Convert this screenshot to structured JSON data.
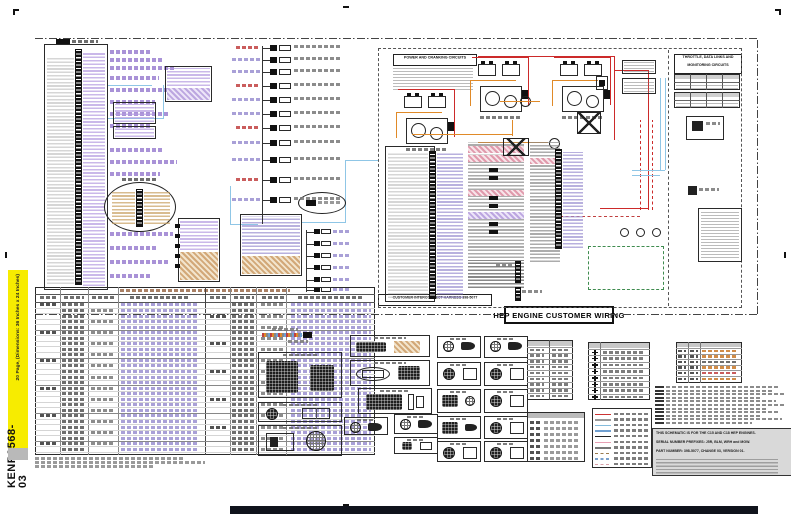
{
  "page": {
    "sheet_code": "KENR9568-03",
    "sheet_subtitle": "20 Page, (Dimensions: 36 Inches x 24 Inches)"
  },
  "titles": {
    "main": "HEP ENGINE CUSTOMER WIRING",
    "power_cranking": "POWER AND CRANKING CIRCUITS",
    "throttle_line1": "THROTTLE, DATA LINKS AND",
    "throttle_line2": "MONITORING CIRCUITS",
    "interconnect": "CUSTOMER INTERCONNECT HARNESS 398-5077"
  },
  "info_box": {
    "line1": "THIS SCHEMATIC IS FOR THE C15 AND C18 HEP ENGINES.",
    "line2": "SERIAL NUMBER PREFIXES: J5R, BLM, WRH and MGW.",
    "line3": "PART NUMBER: 398-5077, CHANGE 03, VERSION 01."
  },
  "legend": {
    "line_styles": [
      {
        "color": "#cc3333",
        "style": "solid"
      },
      {
        "color": "#999999",
        "style": "solid"
      },
      {
        "color": "#85bcdc",
        "style": "solid"
      },
      {
        "color": "#6f9fd0",
        "style": "solid"
      },
      {
        "color": "#222222",
        "style": "solid"
      },
      {
        "color": "#e8a0b4",
        "style": "solid"
      },
      {
        "color": "#777777",
        "style": "solid"
      },
      {
        "color": "#9a7b4f",
        "style": "dashed"
      },
      {
        "color": "#7aa0cc",
        "style": "dashed"
      },
      {
        "color": "#d8a0a8",
        "style": "dashed"
      }
    ]
  },
  "colors": {
    "spine_yellow": "#f7ec00",
    "wire_red": "#cc2a2a",
    "wire_orange": "#e08a28",
    "wire_blue": "#8fc6e6",
    "highlight_lavender": "#b49ae0",
    "highlight_tan": "#c8a060",
    "dashed_green": "#3f8c4f",
    "bottom_bar": "#10131c"
  }
}
